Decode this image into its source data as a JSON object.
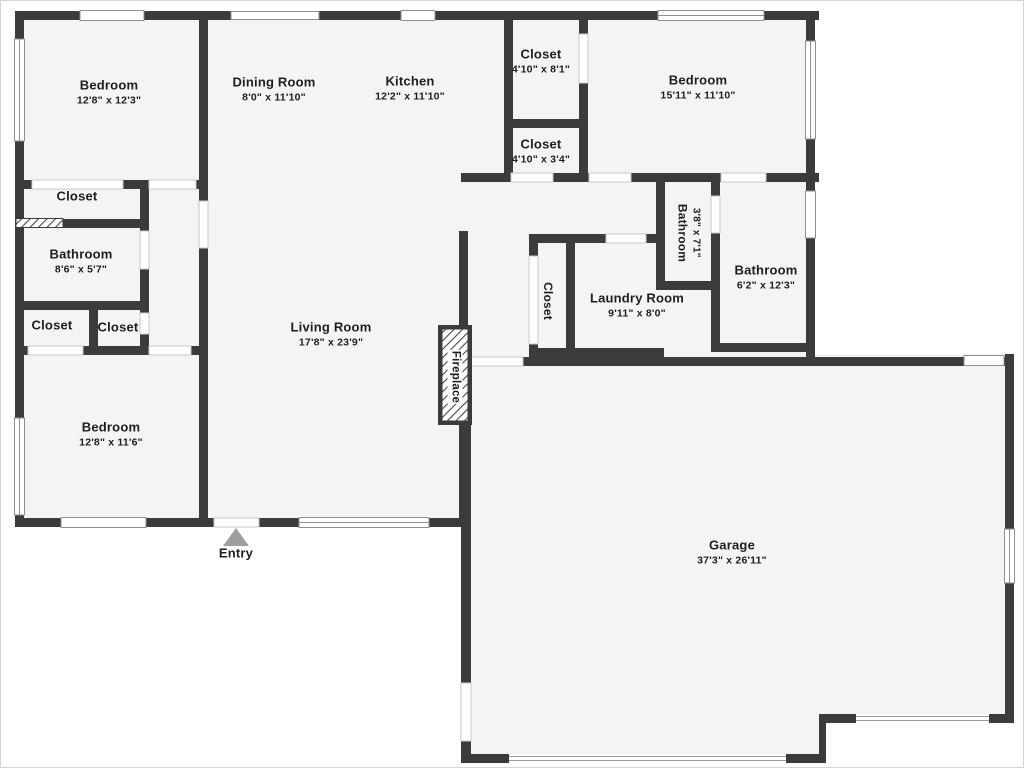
{
  "plan": {
    "type": "residential-floor-plan",
    "colors": {
      "wall": "#3b3b3b",
      "floor": "#f4f4f4",
      "background": "#ffffff",
      "text": "#1e1e1e",
      "entry_arrow": "#9e9e9e"
    },
    "entry_marker": "triangle-up",
    "rooms": [
      {
        "id": "bedroom-tl",
        "name": "Bedroom",
        "dims": "12'8\" x 12'3\"",
        "x": 108,
        "y": 92
      },
      {
        "id": "dining-room",
        "name": "Dining Room",
        "dims": "8'0\" x 11'10\"",
        "x": 273,
        "y": 89
      },
      {
        "id": "kitchen",
        "name": "Kitchen",
        "dims": "12'2\" x 11'10\"",
        "x": 409,
        "y": 88
      },
      {
        "id": "closet-top",
        "name": "Closet",
        "dims": "4'10\" x 8'1\"",
        "x": 540,
        "y": 61
      },
      {
        "id": "closet-upper",
        "name": "Closet",
        "dims": "4'10\" x 3'4\"",
        "x": 540,
        "y": 151
      },
      {
        "id": "bedroom-tr",
        "name": "Bedroom",
        "dims": "15'11\" x 11'10\"",
        "x": 697,
        "y": 87
      },
      {
        "id": "closet-left",
        "name": "Closet",
        "dims": "",
        "x": 76,
        "y": 196
      },
      {
        "id": "bathroom-left",
        "name": "Bathroom",
        "dims": "8'6\" x 5'7\"",
        "x": 80,
        "y": 261
      },
      {
        "id": "closet-bl-left",
        "name": "Closet",
        "dims": "",
        "x": 51,
        "y": 325
      },
      {
        "id": "closet-bl-right",
        "name": "Closet",
        "dims": "",
        "x": 117,
        "y": 327
      },
      {
        "id": "bedroom-bl",
        "name": "Bedroom",
        "dims": "12'8\" x 11'6\"",
        "x": 110,
        "y": 434
      },
      {
        "id": "living-room",
        "name": "Living Room",
        "dims": "17'8\" x 23'9\"",
        "x": 330,
        "y": 334
      },
      {
        "id": "closet-laundry",
        "name": "Closet",
        "dims": "",
        "x": 546,
        "y": 300,
        "vertical": true
      },
      {
        "id": "laundry-room",
        "name": "Laundry Room",
        "dims": "9'11\" x 8'0\"",
        "x": 636,
        "y": 305
      },
      {
        "id": "bathroom-mid",
        "name": "Bathroom",
        "dims": "3'8\" x 7'1\"",
        "x": 687,
        "y": 232,
        "vertical": true
      },
      {
        "id": "bathroom-right",
        "name": "Bathroom",
        "dims": "6'2\" x 12'3\"",
        "x": 765,
        "y": 277
      },
      {
        "id": "fireplace",
        "name": "Fireplace",
        "dims": "",
        "x": 454,
        "y": 376,
        "vertical": true,
        "onHatch": true
      },
      {
        "id": "garage",
        "name": "Garage",
        "dims": "37'3\" x 26'11\"",
        "x": 731,
        "y": 552
      },
      {
        "id": "entry",
        "name": "Entry",
        "dims": "",
        "x": 235,
        "y": 553
      }
    ]
  }
}
